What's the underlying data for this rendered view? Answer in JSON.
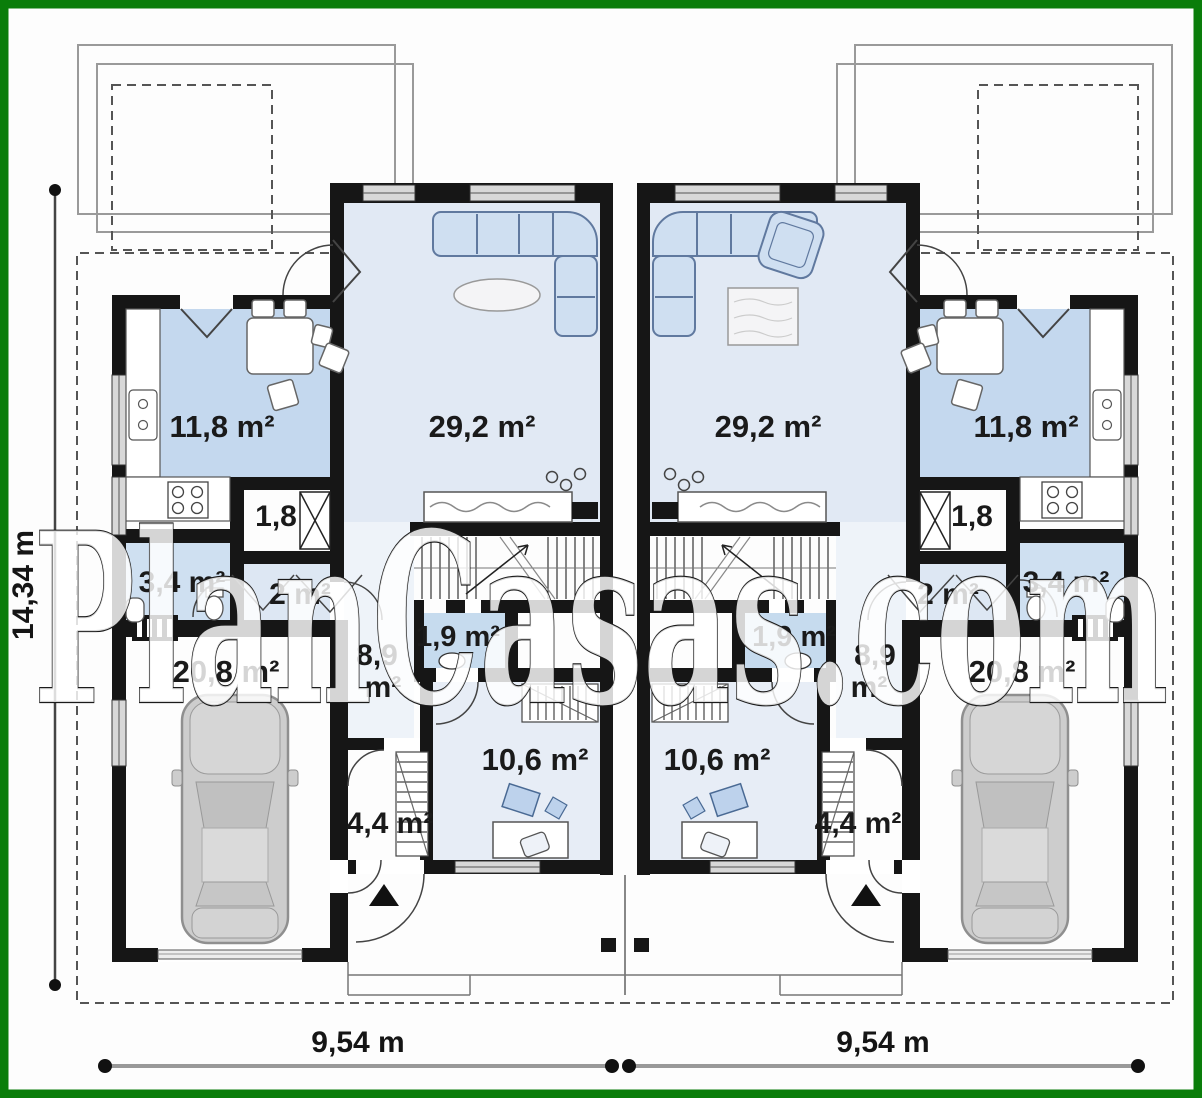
{
  "plan": {
    "watermark_text": "PlanCasas.com",
    "dimensions": {
      "total_depth": "14,34 m",
      "left_unit_width": "9,54 m",
      "right_unit_width": "9,54 m"
    },
    "left_unit": {
      "living_room_area": "29,2 m²",
      "kitchen_area": "11,8 m²",
      "pantry_area": "1,8",
      "bathroom_area": "3,4 m²",
      "hall_area": "2 m²",
      "wc_area": "1,9 m²",
      "corridor_area_value": "8,9",
      "corridor_area_unit": "m²",
      "garage_area": "20,8 m²",
      "bedroom_area": "10,6 m²",
      "vestibule_area": "4,4 m²"
    },
    "right_unit": {
      "living_room_area": "29,2 m²",
      "kitchen_area": "11,8 m²",
      "pantry_area": "1,8",
      "bathroom_area": "3,4 m²",
      "hall_area": "2 m²",
      "wc_area": "1,9 m²",
      "corridor_area_value": "8,9",
      "corridor_area_unit": "m²",
      "garage_area": "20,8 m²",
      "bedroom_area": "10,6 m²",
      "vestibule_area": "4,4 m²"
    },
    "colors": {
      "frame_green": "#0a7d0a",
      "wall_black": "#161616",
      "room_blue_strong": "#c4d8ee",
      "room_blue_light": "#e1e9f4",
      "furniture_blue": "#cfdff1"
    }
  }
}
